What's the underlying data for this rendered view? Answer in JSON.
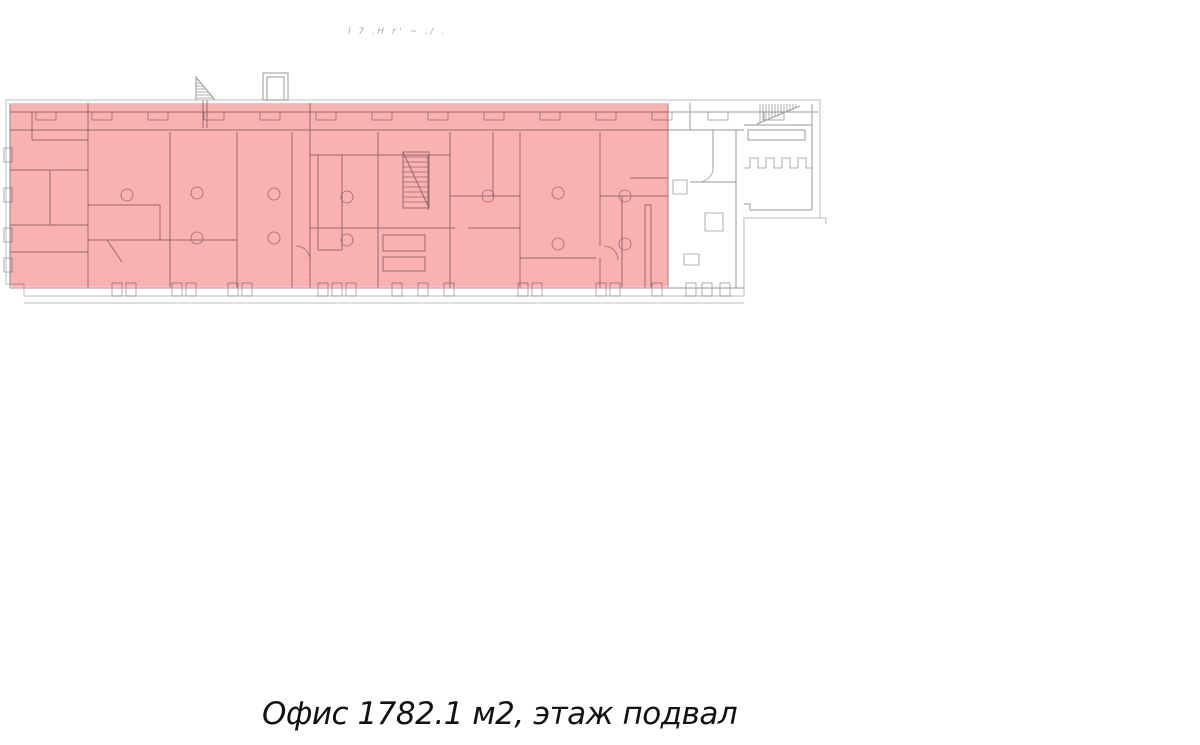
{
  "colors": {
    "highlight": "#f9b1b1",
    "wall": "#9a9a9a",
    "outline": "#c9c9c9",
    "text": "#121212",
    "faint": "#ababab",
    "background": "#ffffff"
  },
  "annotation": {
    "text": "l 7 .Н г' ~ ./ ."
  },
  "caption": {
    "text": "Офис 1782.1 м2, этаж подвал",
    "unit_type": "Офис",
    "area_m2": "1782.1",
    "floor": "подвал"
  }
}
